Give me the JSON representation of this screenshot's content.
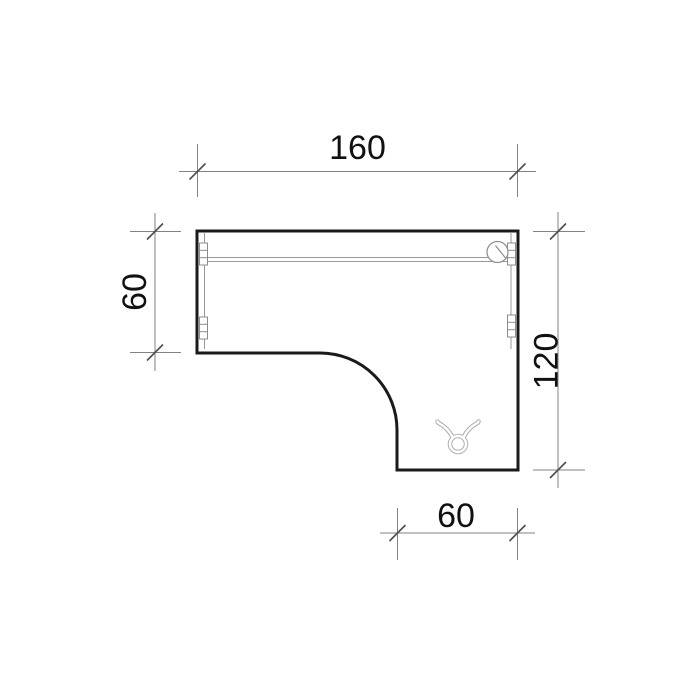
{
  "drawing": {
    "kind": "technical-plan-top-view",
    "dimensions": {
      "top_width": {
        "label": "160"
      },
      "left_height": {
        "label": "60"
      },
      "right_height": {
        "label": "120"
      },
      "bottom_width": {
        "label": "60"
      }
    },
    "icons": [
      {
        "name": "cable-grommet-icon"
      },
      {
        "name": "taurus-logo-icon"
      }
    ],
    "colors": {
      "outline": "#1a1a1a",
      "dimension_lines": "#828282",
      "tick_marks": "#4d4d4d",
      "inner_details": "#999999",
      "watermark": "#b3b3b3",
      "background": "#ffffff",
      "text": "#111111"
    }
  }
}
